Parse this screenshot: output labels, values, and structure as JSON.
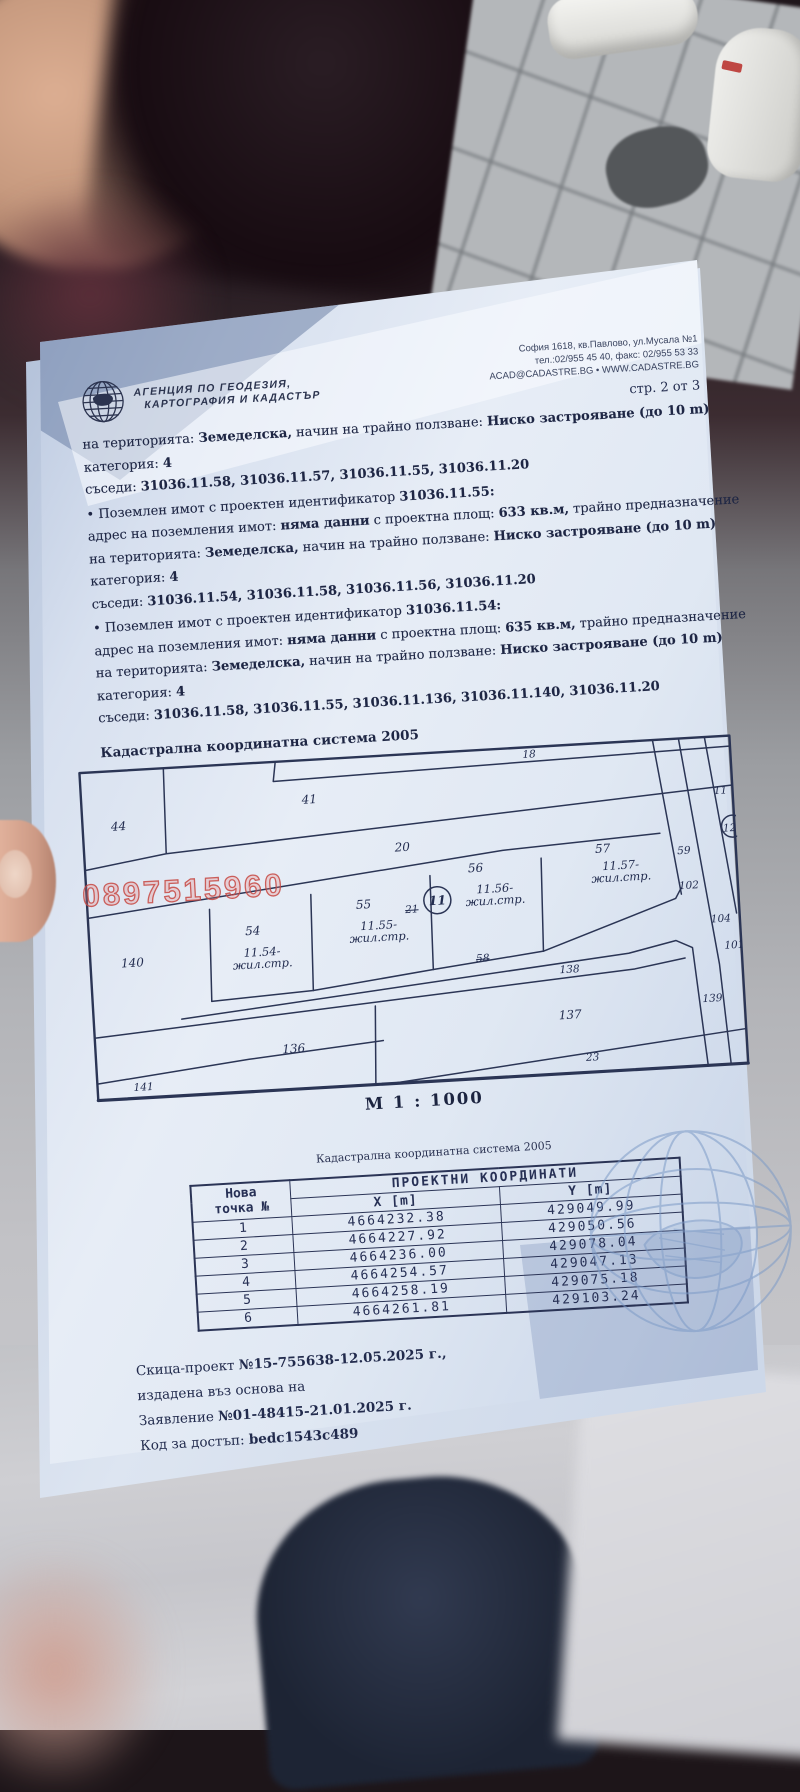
{
  "photo": {
    "watermark_phone": "0897515960"
  },
  "header": {
    "agency_line1": "АГЕНЦИЯ ПО ГЕОДЕЗИЯ,",
    "agency_line2": "КАРТОГРАФИЯ И КАДАСТЪР",
    "address_line1": "София 1618, кв.Павлово, ул.Мусала №1",
    "address_line2": "тел.:02/955 45 40, факс: 02/955 53 33",
    "address_line3": "ACAD@CADASTRE.BG • WWW.CADASTRE.BG",
    "page_label": "стр. 2 от 3"
  },
  "body": {
    "intro": {
      "line1": [
        {
          "t": "на територията: "
        },
        {
          "t": "Земеделска,",
          "b": true
        },
        {
          "t": " начин на трайно ползване: "
        },
        {
          "t": "Ниско застрояване (до 10 m)",
          "b": true
        }
      ],
      "line2": [
        {
          "t": "категория: "
        },
        {
          "t": "4",
          "b": true
        }
      ],
      "line3": [
        {
          "t": "съседи: "
        },
        {
          "t": "31036.11.58, 31036.11.57, 31036.11.55, 31036.11.20",
          "b": true
        }
      ]
    },
    "parcels": [
      {
        "title": [
          {
            "t": "• Поземлен имот с проектен идентификатор "
          },
          {
            "t": "31036.11.55:",
            "b": true
          }
        ],
        "line1": [
          {
            "t": "адрес на поземления имот: "
          },
          {
            "t": "няма данни",
            "b": true
          },
          {
            "t": " с проектна площ: "
          },
          {
            "t": "633 кв.м,",
            "b": true
          },
          {
            "t": " трайно предназначение"
          }
        ],
        "line2": [
          {
            "t": "на територията: "
          },
          {
            "t": "Земеделска,",
            "b": true
          },
          {
            "t": " начин на трайно ползване: "
          },
          {
            "t": "Ниско застрояване (до 10 m)",
            "b": true
          }
        ],
        "line3": [
          {
            "t": "категория: "
          },
          {
            "t": "4",
            "b": true
          }
        ],
        "line4": [
          {
            "t": "съседи: "
          },
          {
            "t": "31036.11.54, 31036.11.58, 31036.11.56, 31036.11.20",
            "b": true
          }
        ]
      },
      {
        "title": [
          {
            "t": "• Поземлен имот с проектен идентификатор "
          },
          {
            "t": "31036.11.54:",
            "b": true
          }
        ],
        "line1": [
          {
            "t": "адрес на поземления имот: "
          },
          {
            "t": "няма данни",
            "b": true
          },
          {
            "t": " с проектна площ: "
          },
          {
            "t": "635 кв.м,",
            "b": true
          },
          {
            "t": " трайно предназначение"
          }
        ],
        "line2": [
          {
            "t": "на територията: "
          },
          {
            "t": "Земеделска,",
            "b": true
          },
          {
            "t": " начин на трайно ползване: "
          },
          {
            "t": "Ниско застрояване (до 10 m)",
            "b": true
          }
        ],
        "line3": [
          {
            "t": "категория: "
          },
          {
            "t": "4",
            "b": true
          }
        ],
        "line4": [
          {
            "t": "съседи: "
          },
          {
            "t": "31036.11.58, 31036.11.55, 31036.11.136, 31036.11.140, 31036.11.20",
            "b": true
          }
        ]
      }
    ]
  },
  "map": {
    "title": "Кадастрална координатна система 2005",
    "scale_label": "М 1 : 1000",
    "parcels": {
      "p44": "44",
      "p41": "41",
      "p18": "18",
      "p20": "20",
      "p140": "140",
      "p54": "54",
      "p55": "55",
      "p21": "21",
      "p11c": "11",
      "p56": "56",
      "p57": "57",
      "p59": "59",
      "p11e": "11",
      "p12": "12",
      "p102": "102",
      "p104": "104",
      "p101": "101",
      "p58": "58",
      "p138": "138",
      "p139": "139",
      "p137": "137",
      "p136": "136",
      "p141": "141",
      "p23": "23"
    },
    "buildings": {
      "b54_l1": "11.54-",
      "b54_l2": "жил.стр.",
      "b55_l1": "11.55-",
      "b55_l2": "жил.стр.",
      "b56_l1": "11.56-",
      "b56_l2": "жил.стр.",
      "b57_l1": "11.57-",
      "b57_l2": "жил.стр."
    }
  },
  "coords": {
    "system_label": "Кадастрална координатна система 2005",
    "table": {
      "col_point_l1": "Нова",
      "col_point_l2": "точка №",
      "group_header": "ПРОЕКТНИ КООРДИНАТИ",
      "x_header": "X [m]",
      "y_header": "Y [m]",
      "rows": [
        {
          "n": "1",
          "x": "4664232.38",
          "y": "429049.99"
        },
        {
          "n": "2",
          "x": "4664227.92",
          "y": "429050.56"
        },
        {
          "n": "3",
          "x": "4664236.00",
          "y": "429078.04"
        },
        {
          "n": "4",
          "x": "4664254.57",
          "y": "429047.13"
        },
        {
          "n": "5",
          "x": "4664258.19",
          "y": "429075.18"
        },
        {
          "n": "6",
          "x": "4664261.81",
          "y": "429103.24"
        }
      ]
    }
  },
  "footer": {
    "line1": [
      {
        "t": "Скица-проект "
      },
      {
        "t": "№15-755638-12.05.2025 г.,",
        "b": true
      }
    ],
    "line2": [
      {
        "t": "издадена въз основа на"
      }
    ],
    "line3": [
      {
        "t": "Заявление "
      },
      {
        "t": "№01-48415-21.01.2025 г.",
        "b": true
      }
    ],
    "line4": [
      {
        "t": "Код за достъп: "
      },
      {
        "t": "bedc1543c489",
        "b": true
      }
    ]
  },
  "colors": {
    "paper_tint": "#dde5f2",
    "ink": "#1e2644",
    "map_line": "#2b3555",
    "watermark_red": "#c75f5f",
    "globe_blue": "#7d9bc7"
  }
}
